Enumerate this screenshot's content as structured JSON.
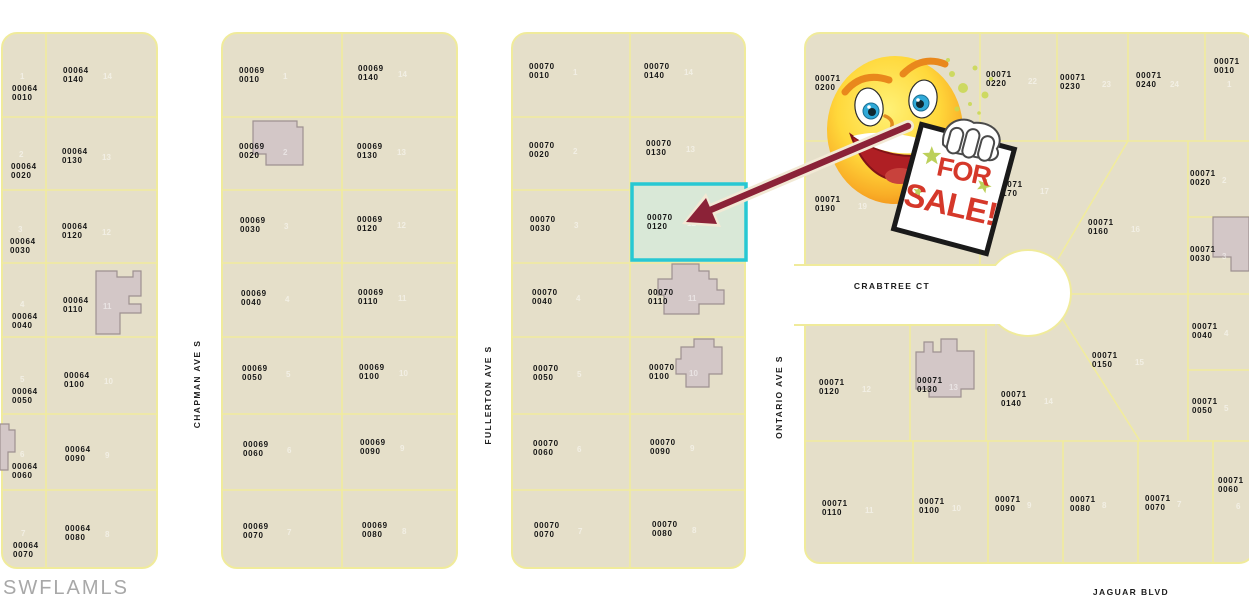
{
  "map": {
    "watermark": "SWFLAMLS",
    "highlight": {
      "parcel_book": "00070",
      "parcel_number": "0120"
    },
    "sale_sign": {
      "word1": "FOR",
      "word2": "SALE!"
    },
    "colors": {
      "parcel_fill": "#E5DFC9",
      "lot_line": "#F1EC9D",
      "highlight_fill": "#D9E8D7",
      "highlight_border": "#27C8D3",
      "building_fill": "#D3C7C7",
      "building_outline": "#9E9191",
      "arrow_maroon": "#8B2237",
      "sign_text_red": "#D5382A",
      "star_green": "#BCD05A",
      "smiley_yellow": "#FFD83B",
      "watermark_gray": "#A8A8A8"
    },
    "streets": [
      {
        "name": "CHAPMAN AVE S",
        "orientation": "vertical",
        "x": 197,
        "y": 384
      },
      {
        "name": "FULLERTON AVE S",
        "orientation": "vertical",
        "x": 488,
        "y": 395
      },
      {
        "name": "ONTARIO AVE S",
        "orientation": "vertical",
        "x": 779,
        "y": 397
      },
      {
        "name": "CRABTREE CT",
        "orientation": "horizontal",
        "x": 892,
        "y": 286
      },
      {
        "name": "JAGUAR BLVD",
        "orientation": "horizontal",
        "x": 1131,
        "y": 592
      }
    ],
    "parcels": [
      {
        "b": "00064",
        "n": "0010",
        "lot": "1",
        "x": 12,
        "y": 85,
        "lx": 20,
        "ly": 72
      },
      {
        "b": "00064",
        "n": "0020",
        "lot": "2",
        "x": 11,
        "y": 163,
        "lx": 19,
        "ly": 150
      },
      {
        "b": "00064",
        "n": "0030",
        "lot": "3",
        "x": 10,
        "y": 238,
        "lx": 18,
        "ly": 225
      },
      {
        "b": "00064",
        "n": "0040",
        "lot": "4",
        "x": 12,
        "y": 313,
        "lx": 20,
        "ly": 300
      },
      {
        "b": "00064",
        "n": "0050",
        "lot": "5",
        "x": 12,
        "y": 388,
        "lx": 20,
        "ly": 375
      },
      {
        "b": "00064",
        "n": "0060",
        "lot": "6",
        "x": 12,
        "y": 463,
        "lx": 20,
        "ly": 450
      },
      {
        "b": "00064",
        "n": "0070",
        "lot": "7",
        "x": 13,
        "y": 542,
        "lx": 21,
        "ly": 529
      },
      {
        "b": "00064",
        "n": "0140",
        "lot": "14",
        "x": 63,
        "y": 67,
        "lx": 103,
        "ly": 72
      },
      {
        "b": "00064",
        "n": "0130",
        "lot": "13",
        "x": 62,
        "y": 148,
        "lx": 102,
        "ly": 153
      },
      {
        "b": "00064",
        "n": "0120",
        "lot": "12",
        "x": 62,
        "y": 223,
        "lx": 102,
        "ly": 228
      },
      {
        "b": "00064",
        "n": "0110",
        "lot": "11",
        "x": 63,
        "y": 297,
        "lx": 103,
        "ly": 302
      },
      {
        "b": "00064",
        "n": "0100",
        "lot": "10",
        "x": 64,
        "y": 372,
        "lx": 104,
        "ly": 377
      },
      {
        "b": "00064",
        "n": "0090",
        "lot": "9",
        "x": 65,
        "y": 446,
        "lx": 105,
        "ly": 451
      },
      {
        "b": "00064",
        "n": "0080",
        "lot": "8",
        "x": 65,
        "y": 525,
        "lx": 105,
        "ly": 530
      },
      {
        "b": "00069",
        "n": "0010",
        "lot": "1",
        "x": 239,
        "y": 67,
        "lx": 283,
        "ly": 72
      },
      {
        "b": "00069",
        "n": "0020",
        "lot": "2",
        "x": 239,
        "y": 143,
        "lx": 283,
        "ly": 148
      },
      {
        "b": "00069",
        "n": "0030",
        "lot": "3",
        "x": 240,
        "y": 217,
        "lx": 284,
        "ly": 222
      },
      {
        "b": "00069",
        "n": "0040",
        "lot": "4",
        "x": 241,
        "y": 290,
        "lx": 285,
        "ly": 295
      },
      {
        "b": "00069",
        "n": "0050",
        "lot": "5",
        "x": 242,
        "y": 365,
        "lx": 286,
        "ly": 370
      },
      {
        "b": "00069",
        "n": "0060",
        "lot": "6",
        "x": 243,
        "y": 441,
        "lx": 287,
        "ly": 446
      },
      {
        "b": "00069",
        "n": "0070",
        "lot": "7",
        "x": 243,
        "y": 523,
        "lx": 287,
        "ly": 528
      },
      {
        "b": "00069",
        "n": "0140",
        "lot": "14",
        "x": 358,
        "y": 65,
        "lx": 398,
        "ly": 70
      },
      {
        "b": "00069",
        "n": "0130",
        "lot": "13",
        "x": 357,
        "y": 143,
        "lx": 397,
        "ly": 148
      },
      {
        "b": "00069",
        "n": "0120",
        "lot": "12",
        "x": 357,
        "y": 216,
        "lx": 397,
        "ly": 221
      },
      {
        "b": "00069",
        "n": "0110",
        "lot": "11",
        "x": 358,
        "y": 289,
        "lx": 398,
        "ly": 294
      },
      {
        "b": "00069",
        "n": "0100",
        "lot": "10",
        "x": 359,
        "y": 364,
        "lx": 399,
        "ly": 369
      },
      {
        "b": "00069",
        "n": "0090",
        "lot": "9",
        "x": 360,
        "y": 439,
        "lx": 400,
        "ly": 444
      },
      {
        "b": "00069",
        "n": "0080",
        "lot": "8",
        "x": 362,
        "y": 522,
        "lx": 402,
        "ly": 527
      },
      {
        "b": "00070",
        "n": "0010",
        "lot": "1",
        "x": 529,
        "y": 63,
        "lx": 573,
        "ly": 68
      },
      {
        "b": "00070",
        "n": "0020",
        "lot": "2",
        "x": 529,
        "y": 142,
        "lx": 573,
        "ly": 147
      },
      {
        "b": "00070",
        "n": "0030",
        "lot": "3",
        "x": 530,
        "y": 216,
        "lx": 574,
        "ly": 221
      },
      {
        "b": "00070",
        "n": "0040",
        "lot": "4",
        "x": 532,
        "y": 289,
        "lx": 576,
        "ly": 294
      },
      {
        "b": "00070",
        "n": "0050",
        "lot": "5",
        "x": 533,
        "y": 365,
        "lx": 577,
        "ly": 370
      },
      {
        "b": "00070",
        "n": "0060",
        "lot": "6",
        "x": 533,
        "y": 440,
        "lx": 577,
        "ly": 445
      },
      {
        "b": "00070",
        "n": "0070",
        "lot": "7",
        "x": 534,
        "y": 522,
        "lx": 578,
        "ly": 527
      },
      {
        "b": "00070",
        "n": "0140",
        "lot": "14",
        "x": 644,
        "y": 63,
        "lx": 684,
        "ly": 68
      },
      {
        "b": "00070",
        "n": "0130",
        "lot": "13",
        "x": 646,
        "y": 140,
        "lx": 686,
        "ly": 145
      },
      {
        "b": "00070",
        "n": "0120",
        "lot": "12",
        "x": 647,
        "y": 214,
        "lx": 687,
        "ly": 219
      },
      {
        "b": "00070",
        "n": "0110",
        "lot": "11",
        "x": 648,
        "y": 289,
        "lx": 688,
        "ly": 294
      },
      {
        "b": "00070",
        "n": "0100",
        "lot": "10",
        "x": 649,
        "y": 364,
        "lx": 689,
        "ly": 369
      },
      {
        "b": "00070",
        "n": "0090",
        "lot": "9",
        "x": 650,
        "y": 439,
        "lx": 690,
        "ly": 444
      },
      {
        "b": "00070",
        "n": "0080",
        "lot": "8",
        "x": 652,
        "y": 521,
        "lx": 692,
        "ly": 526
      },
      {
        "b": "00071",
        "n": "0200",
        "lot": "20",
        "x": 815,
        "y": 75,
        "lx": 858,
        "ly": 81
      },
      {
        "b": "00071",
        "n": "0220",
        "lot": "22",
        "x": 986,
        "y": 71,
        "lx": 1028,
        "ly": 77
      },
      {
        "b": "00071",
        "n": "0230",
        "lot": "23",
        "x": 1060,
        "y": 74,
        "lx": 1102,
        "ly": 80
      },
      {
        "b": "00071",
        "n": "0240",
        "lot": "24",
        "x": 1136,
        "y": 72,
        "lx": 1170,
        "ly": 80
      },
      {
        "b": "00071",
        "n": "0010",
        "lot": "1",
        "x": 1214,
        "y": 58,
        "lx": 1227,
        "ly": 80
      },
      {
        "b": "00071",
        "n": "0190",
        "lot": "19",
        "x": 815,
        "y": 196,
        "lx": 858,
        "ly": 202
      },
      {
        "b": "00071",
        "n": "0170",
        "lot": "17",
        "x": 997,
        "y": 181,
        "lx": 1040,
        "ly": 187
      },
      {
        "b": "00071",
        "n": "0160",
        "lot": "16",
        "x": 1088,
        "y": 219,
        "lx": 1131,
        "ly": 225
      },
      {
        "b": "00071",
        "n": "0020",
        "lot": "2",
        "x": 1190,
        "y": 170,
        "lx": 1222,
        "ly": 176
      },
      {
        "b": "00071",
        "n": "0030",
        "lot": "3",
        "x": 1190,
        "y": 246,
        "lx": 1222,
        "ly": 252
      },
      {
        "b": "00071",
        "n": "0120",
        "lot": "12",
        "x": 819,
        "y": 379,
        "lx": 862,
        "ly": 385
      },
      {
        "b": "00071",
        "n": "0130",
        "lot": "13",
        "x": 917,
        "y": 377,
        "lx": 949,
        "ly": 383
      },
      {
        "b": "00071",
        "n": "0140",
        "lot": "14",
        "x": 1001,
        "y": 391,
        "lx": 1044,
        "ly": 397
      },
      {
        "b": "00071",
        "n": "0150",
        "lot": "15",
        "x": 1092,
        "y": 352,
        "lx": 1135,
        "ly": 358
      },
      {
        "b": "00071",
        "n": "0040",
        "lot": "4",
        "x": 1192,
        "y": 323,
        "lx": 1224,
        "ly": 329
      },
      {
        "b": "00071",
        "n": "0050",
        "lot": "5",
        "x": 1192,
        "y": 398,
        "lx": 1224,
        "ly": 404
      },
      {
        "b": "00071",
        "n": "0110",
        "lot": "11",
        "x": 822,
        "y": 500,
        "lx": 865,
        "ly": 506
      },
      {
        "b": "00071",
        "n": "0100",
        "lot": "10",
        "x": 919,
        "y": 498,
        "lx": 952,
        "ly": 504
      },
      {
        "b": "00071",
        "n": "0090",
        "lot": "9",
        "x": 995,
        "y": 496,
        "lx": 1027,
        "ly": 501
      },
      {
        "b": "00071",
        "n": "0080",
        "lot": "8",
        "x": 1070,
        "y": 496,
        "lx": 1102,
        "ly": 501
      },
      {
        "b": "00071",
        "n": "0070",
        "lot": "7",
        "x": 1145,
        "y": 495,
        "lx": 1177,
        "ly": 500
      },
      {
        "b": "00071",
        "n": "0060",
        "lot": "6",
        "x": 1218,
        "y": 477,
        "lx": 1236,
        "ly": 502
      }
    ]
  }
}
